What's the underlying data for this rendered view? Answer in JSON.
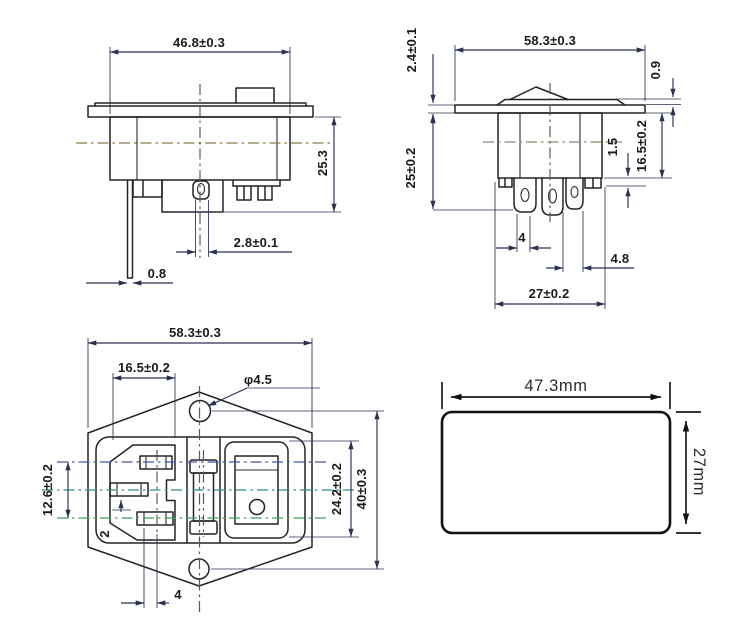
{
  "drawing": {
    "background": "#ffffff",
    "colors": {
      "line": "#232323",
      "dimension": "#2a3152",
      "centerline_olive": "#8a7a45",
      "centerline_blue": "#4656a8",
      "centerline_teal": "#2f9090",
      "centerline_green": "#3f9e63",
      "leader_brown": "#8a6a45",
      "cutout_line": "#111111"
    },
    "views": {
      "side_plain": {
        "dims": {
          "width": "46.8±0.3",
          "depth": "25.3",
          "pin_width": "2.8±0.1",
          "pin_thickness": "0.8"
        }
      },
      "side_switch": {
        "dims": {
          "width": "58.3±0.3",
          "flange_thickness": "2.4±0.1",
          "bezel_height": "0.9",
          "depth": "25±0.2",
          "body_depth": "16.5±0.2",
          "tab_step": "1.5",
          "pin_pitch": "4",
          "lug_width": "4.8",
          "pin_span": "27±0.2"
        }
      },
      "front": {
        "dims": {
          "width": "58.3±0.3",
          "socket_width": "16.5±0.2",
          "hole_diameter": "φ4.5",
          "pin_group_height": "12.6±0.2",
          "pin_offset": "2",
          "switch_aperture_height": "24.2±0.2",
          "hole_pitch": "40±0.3",
          "pin_pitch": "4"
        }
      },
      "panel_cutout": {
        "dims": {
          "width": "47.3mm",
          "height": "27mm"
        }
      }
    }
  }
}
